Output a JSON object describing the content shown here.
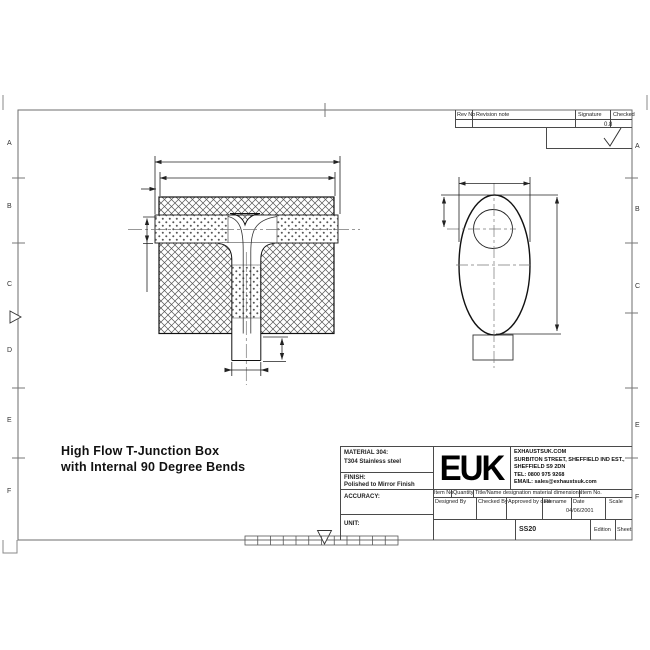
{
  "drawing_title": {
    "line1": "High Flow T-Junction Box",
    "line2": "with Internal 90 Degree Bends"
  },
  "border": {
    "left_letters": [
      "A",
      "B",
      "C",
      "D",
      "E",
      "F"
    ],
    "right_letters": [
      "A",
      "B",
      "C",
      "E",
      "F"
    ]
  },
  "revision_table": {
    "rev_no": "Rev No",
    "revision_note": "Revision note",
    "signature": "Signature",
    "checked": "Checked"
  },
  "surface_finish": {
    "value": "0.8"
  },
  "title_block": {
    "material_label": "MATERIAL 304:",
    "material_value": "T304 Stainless steel",
    "finish_label": "FINISH:",
    "finish_value": "Polished to Mirror Finish",
    "accuracy_label": "ACCURACY:",
    "unit_label": "UNIT:",
    "logo": "EUK",
    "company": {
      "line1": "EXHAUSTSUK.COM",
      "line2": "SURBITON STREET, SHEFFIELD IND EST.,",
      "line3": "SHEFFIELD S9 2DN",
      "line4": "TEL: 0800 975 9268",
      "line5": "EMAIL: sales@exhaustsuk.com"
    },
    "item_row": [
      "Item No",
      "Quantity",
      "Title/Name designation material dimensions",
      "Item No."
    ],
    "approval_row": [
      "Designed By",
      "Checked By",
      "Approved by date",
      "Filename",
      "Date",
      "Scale"
    ],
    "date_value": "04/06/2001",
    "part_number": "SS20",
    "edition_label": "Edition",
    "sheet_label": "Sheet"
  },
  "colors": {
    "line": "#111111",
    "frame": "#6e6e6e",
    "table_line": "#4a4a4a"
  }
}
